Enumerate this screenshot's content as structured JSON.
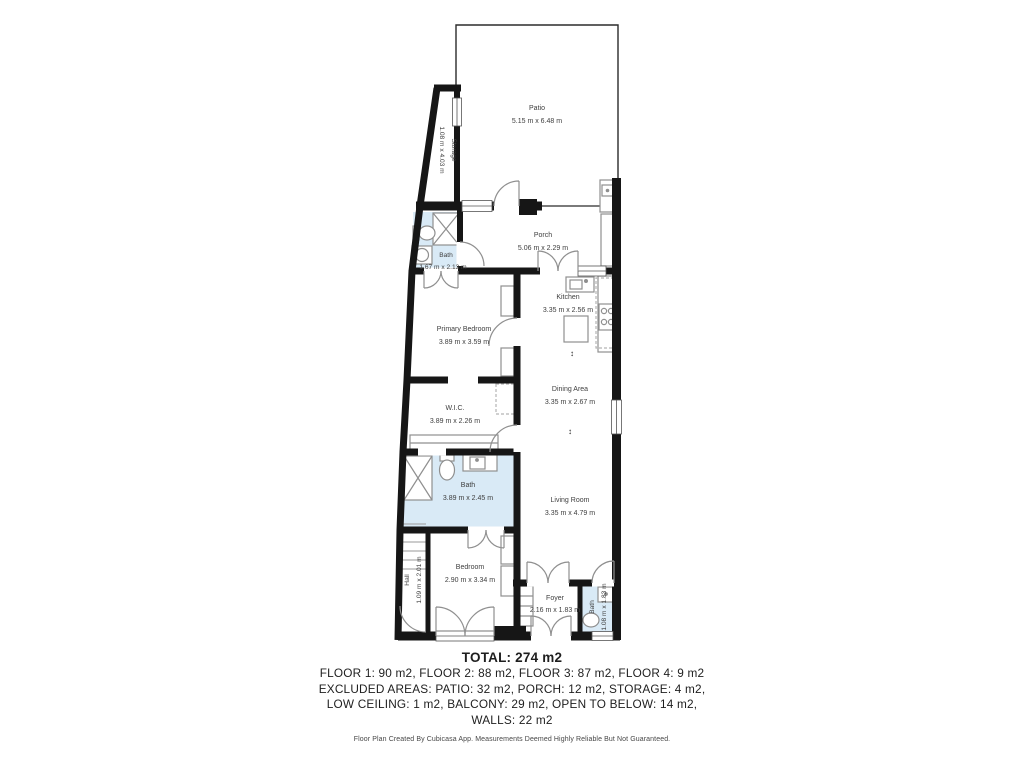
{
  "plan": {
    "rooms": {
      "patio": {
        "name": "Patio",
        "dims": "5.15 m x 6.48 m"
      },
      "storage": {
        "name": "Storage",
        "dims": "1.08 m x 4.03 m"
      },
      "bath_top": {
        "name": "Bath",
        "dims": "1.67 m x 2.13 m"
      },
      "porch": {
        "name": "Porch",
        "dims": "5.06 m x 2.29 m"
      },
      "kitchen": {
        "name": "Kitchen",
        "dims": "3.35 m x 2.56 m"
      },
      "primary_bedroom": {
        "name": "Primary Bedroom",
        "dims": "3.89 m x 3.59 m"
      },
      "dining": {
        "name": "Dining Area",
        "dims": "3.35 m x 2.67 m"
      },
      "wic": {
        "name": "W.I.C.",
        "dims": "3.89 m x 2.26 m"
      },
      "bath_mid": {
        "name": "Bath",
        "dims": "3.89 m x 2.45 m"
      },
      "living": {
        "name": "Living Room",
        "dims": "3.35 m x 4.79 m"
      },
      "bedroom": {
        "name": "Bedroom",
        "dims": "2.90 m x 3.34 m"
      },
      "hall": {
        "name": "Hall",
        "dims": "1.09 m x 2.01 m"
      },
      "foyer": {
        "name": "Foyer",
        "dims": "2.16 m x 1.83 m"
      },
      "bath_entry": {
        "name": "Bath",
        "dims": "1.08 m x 1.83 m"
      }
    }
  },
  "symbols": {
    "level_arrow": "↕"
  },
  "summary": {
    "total": "TOTAL: 274 m2",
    "lines": [
      "FLOOR 1: 90 m2, FLOOR 2: 88 m2, FLOOR 3: 87 m2, FLOOR 4: 9 m2",
      "EXCLUDED AREAS: PATIO: 32 m2, PORCH: 12 m2, STORAGE: 4 m2,",
      "LOW CEILING: 1 m2, BALCONY: 29 m2, OPEN TO BELOW: 14 m2,",
      "WALLS: 22 m2"
    ],
    "disclaimer": "Floor Plan Created By Cubicasa App. Measurements Deemed Highly Reliable But Not Guaranteed."
  },
  "colors": {
    "wall": "#161616",
    "bath_floor": "#d9eaf6",
    "fixture": "#8f8f8f",
    "label_text": "#3e3e3e"
  }
}
